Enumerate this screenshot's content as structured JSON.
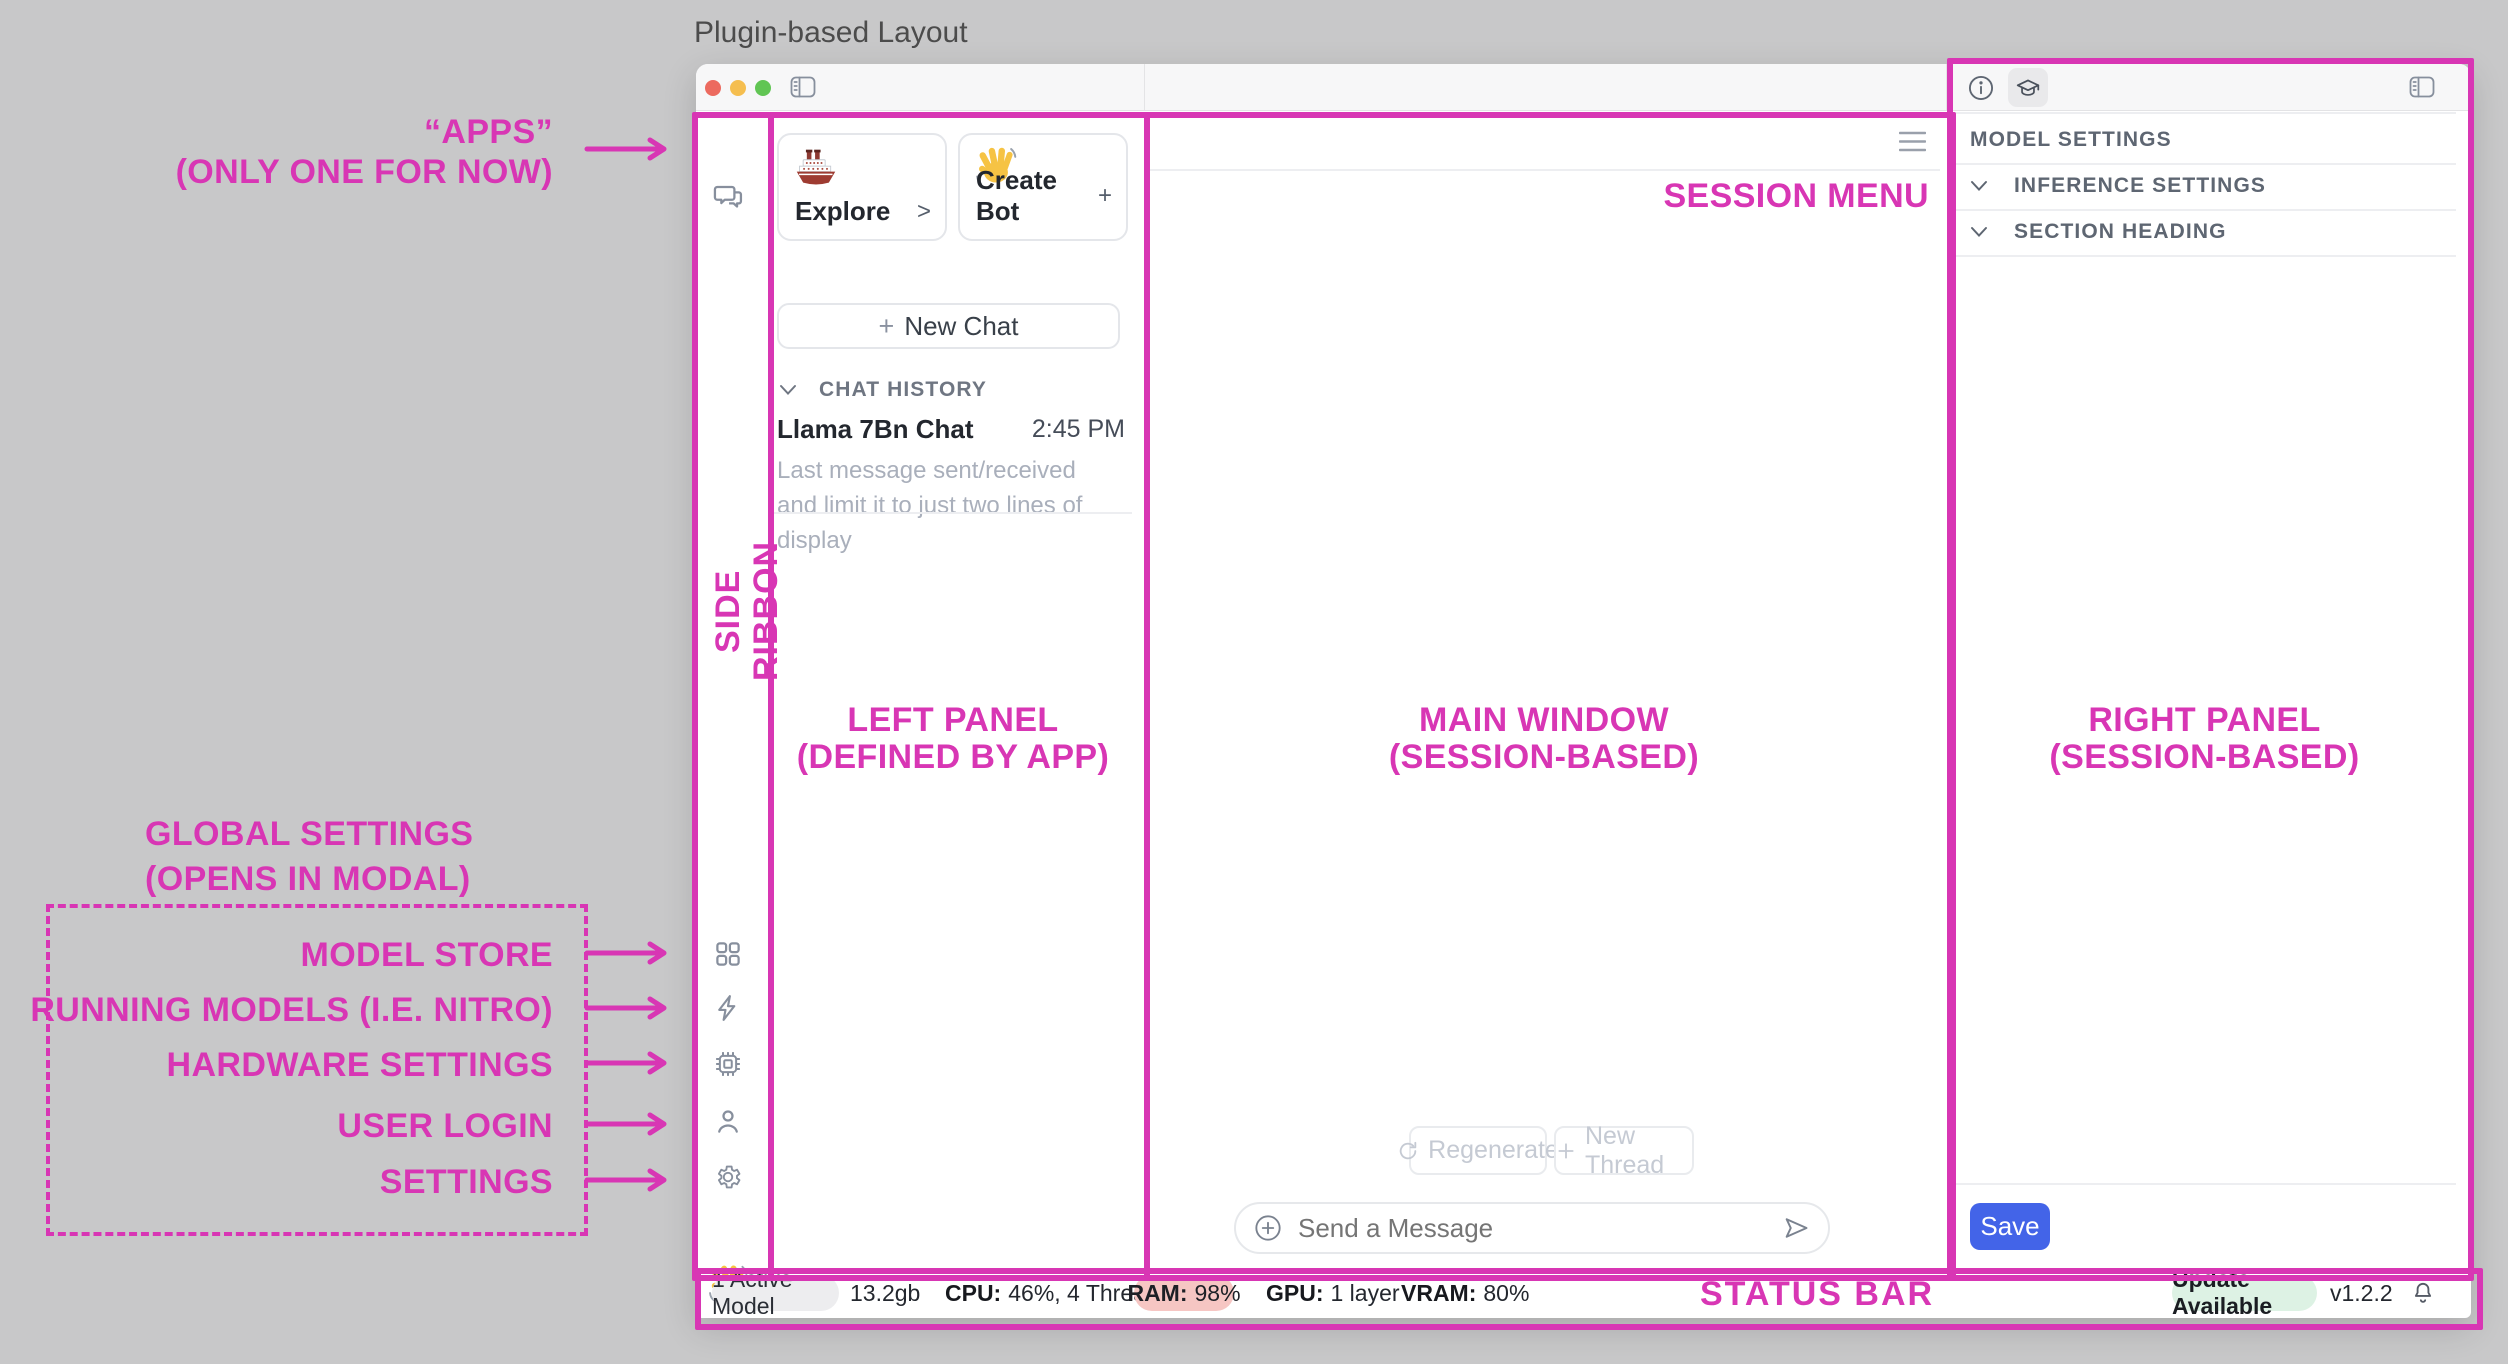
{
  "page_title": "Plugin-based Layout",
  "colors": {
    "accent": "#D836B4",
    "save_blue": "#4364E8",
    "ram_badge_bg": "#F6C6C3",
    "update_badge_bg": "#DDF2E4",
    "active_badge_bg": "#EDEDEF",
    "traffic_red": "#EC6A5F",
    "traffic_yellow": "#F5BE4F",
    "traffic_green": "#61C554"
  },
  "icons": {
    "titlebar": [
      "close",
      "minimize",
      "zoom",
      "sidebar-toggle"
    ],
    "ribbon": [
      "chat-bubbles",
      "apps-grid",
      "bolt",
      "chip",
      "user",
      "gear",
      "wave-emoji"
    ],
    "right_header": [
      "info",
      "graduation-cap",
      "panel-toggle"
    ],
    "misc": [
      "hamburger-menu",
      "refresh",
      "plus",
      "circle-plus",
      "send",
      "chevron-down",
      "bell",
      "ship-emoji"
    ]
  },
  "annotations": {
    "apps_line1": "“APPS”",
    "apps_line2": "(ONLY ONE FOR NOW)",
    "side_ribbon": "SIDE RIBBON",
    "left_panel_line1": "LEFT PANEL",
    "left_panel_line2": "(DEFINED BY APP)",
    "main_window_line1": "MAIN WINDOW",
    "main_window_line2": "(SESSION-BASED)",
    "session_menu": "SESSION MENU",
    "right_panel_line1": "RIGHT PANEL",
    "right_panel_line2": "(SESSION-BASED)",
    "status_bar": "STATUS BAR",
    "global_line1": "GLOBAL SETTINGS",
    "global_line2": "(OPENS IN MODAL)",
    "model_store": "MODEL STORE",
    "running_models": "RUNNING MODELS (I.E. NITRO)",
    "hardware_settings": "HARDWARE SETTINGS",
    "user_login": "USER LOGIN",
    "settings": "SETTINGS"
  },
  "left_panel": {
    "explore_label": "Explore",
    "explore_affix": ">",
    "create_bot_label": "Create Bot",
    "create_bot_affix": "+",
    "new_chat_plus": "+",
    "new_chat_label": "New Chat",
    "history_heading": "CHAT HISTORY",
    "chat_title": "Llama 7Bn Chat",
    "chat_time": "2:45 PM",
    "chat_preview": "Last message sent/received and limit it to just two lines of display"
  },
  "main_window": {
    "regenerate_label": "Regenerate",
    "new_thread_label": "New Thread",
    "composer_placeholder": "Send a Message"
  },
  "right_panel": {
    "model_settings": "MODEL SETTINGS",
    "inference_settings": "INFERENCE SETTINGS",
    "section_heading": "SECTION HEADING",
    "save_label": "Save"
  },
  "status_bar": {
    "active_model": "1 Active Model",
    "model_size": "13.2gb",
    "cpu_label": "CPU:",
    "cpu_value": "46%, 4 Threads",
    "ram_label": "RAM:",
    "ram_value": "98%",
    "gpu_label": "GPU:",
    "gpu_value": "1 layer",
    "vram_label": "VRAM:",
    "vram_value": "80%",
    "update_badge": "Update Available",
    "version": "v1.2.2"
  }
}
